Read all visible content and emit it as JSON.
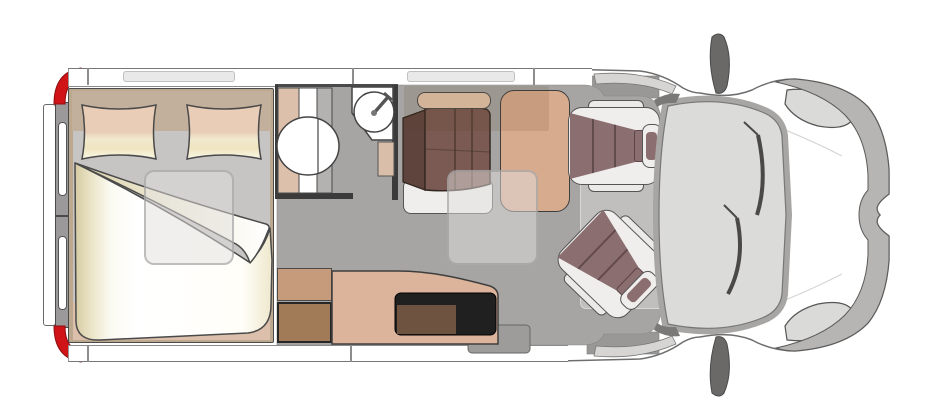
{
  "meta": {
    "title": "Campervan floor plan — top view",
    "diagram_type": "vehicle-floorplan",
    "vehicle_front": "right",
    "text_on_image": "none"
  },
  "components": [
    "rear-double-doors",
    "tail-lights",
    "double-bed",
    "pillows",
    "duvet",
    "skylight-over-bed",
    "bathroom",
    "toilet",
    "corner-washbasin",
    "wardrobe",
    "refrigerator",
    "kitchen-counter",
    "cooktop",
    "dinette-bench",
    "dinette-table",
    "skylight-over-dinette",
    "sliding-door-step",
    "passenger-swivel-seat",
    "driver-swivel-seat",
    "cab-windshield",
    "wing-mirrors",
    "headlights",
    "front-bumper"
  ],
  "palette": {
    "page_bg": "#ffffff",
    "outline": "#4a4a4a",
    "body_outline": "#6e6e6e",
    "floor": "#a7a5a3",
    "step_gray": "#9e9c9a",
    "wall_white": "#ffffff",
    "window_bar": "#e9e9e9",
    "rear_door_gray": "#9b9999",
    "accent_red": "#d01317",
    "bed_frame": "#bca78f",
    "headboard": "#c3b09c",
    "mattress": "#c7c5c3",
    "foot_strip": "#dcc0ac",
    "bath_beige": "#dcc0ab",
    "bath_gray_strip": "#b4b2b0",
    "wardrobe_tan": "#c59b7c",
    "fridge_brown": "#a17a58",
    "counter_tan": "#dcb49c",
    "cooktop_black": "#202020",
    "cooktop_brown": "#6d5340",
    "bench_maroon": "#7a5a52",
    "bench_dark": "#5e443d",
    "headrest_beige": "#e5c6ac",
    "table_tan": "#d7ab8e",
    "seat_maroon": "#8b6f70",
    "seat_frame": "#f0eeec",
    "glass": "#dbdbd9",
    "frame_gray": "#a8a6a4",
    "headlight": "#dadad8",
    "bumper": "#b7b5b3",
    "mirror_dark": "#6b6967"
  }
}
